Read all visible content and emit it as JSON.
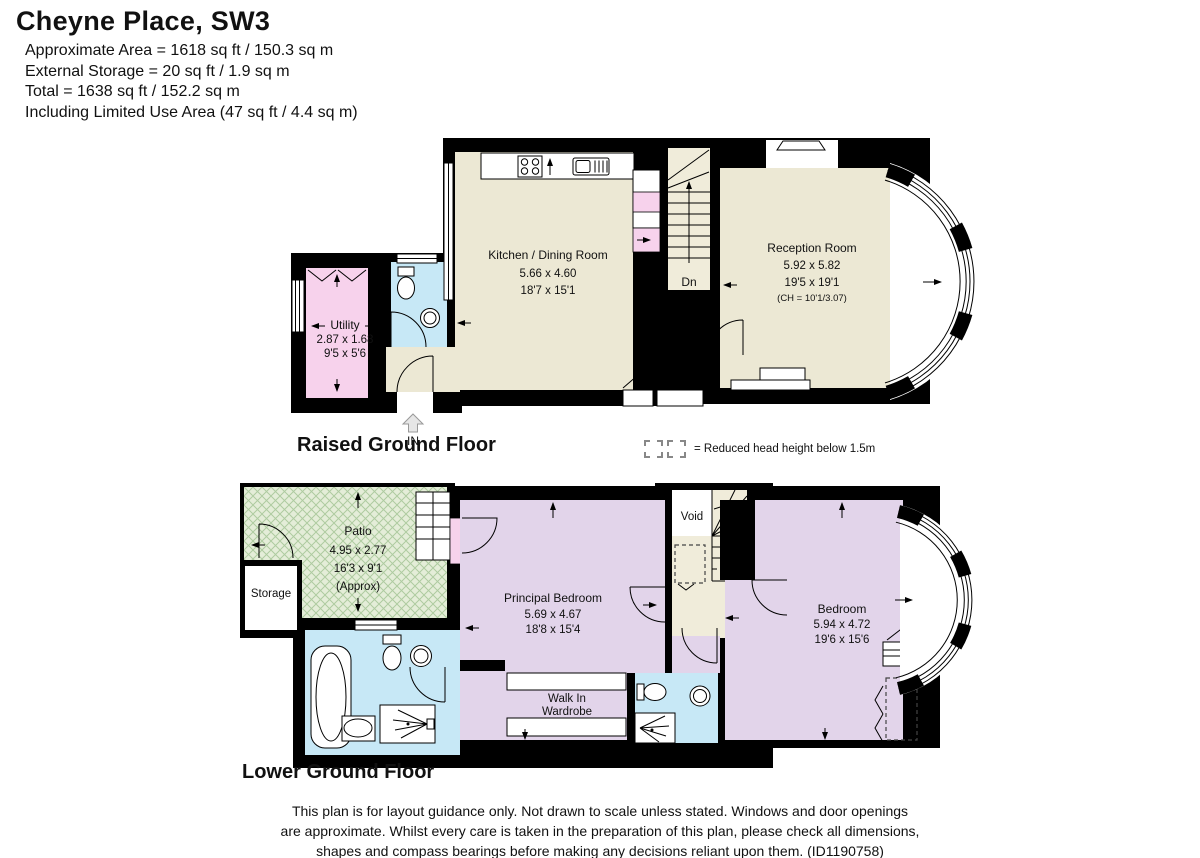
{
  "header": {
    "title": "Cheyne Place, SW3",
    "lines": [
      "Approximate Area = 1618 sq ft / 150.3 sq m",
      "External Storage = 20 sq ft / 1.9 sq m",
      "Total = 1638 sq ft / 152.2 sq m",
      "Including Limited Use Area (47 sq ft / 4.4 sq m)"
    ]
  },
  "floors": {
    "raised_ground": {
      "label": "Raised Ground Floor",
      "stairs_label": "Dn",
      "entrance_label": "IN",
      "rooms": {
        "utility": {
          "name": "Utility",
          "metric": "2.87 x 1.68",
          "imperial": "9'5 x 5'6"
        },
        "kitchen": {
          "name": "Kitchen / Dining Room",
          "metric": "5.66 x 4.60",
          "imperial": "18'7 x 15'1"
        },
        "reception": {
          "name": "Reception Room",
          "metric": "5.92 x 5.82",
          "imperial": "19'5 x 19'1",
          "ceiling": "(CH = 10'1/3.07)"
        }
      }
    },
    "lower_ground": {
      "label": "Lower Ground Floor",
      "stairs_label": "Up",
      "rooms": {
        "patio": {
          "name": "Patio",
          "metric": "4.95 x 2.77",
          "imperial": "16'3 x 9'1",
          "approx": "(Approx)"
        },
        "storage": {
          "name": "Storage"
        },
        "void": {
          "name": "Void"
        },
        "principal_bedroom": {
          "name": "Principal Bedroom",
          "metric": "5.69 x 4.67",
          "imperial": "18'8 x 15'4"
        },
        "walk_in_wardrobe": {
          "line1": "Walk In",
          "line2": "Wardrobe"
        },
        "bedroom": {
          "name": "Bedroom",
          "metric": "5.94 x 4.72",
          "imperial": "19'6 x 15'6"
        }
      }
    }
  },
  "legend": {
    "text": "= Reduced head height below 1.5m"
  },
  "footer": {
    "lines": [
      "This plan is for layout guidance only. Not drawn to scale unless stated. Windows and door openings",
      "are approximate. Whilst every care is taken in the preparation of this plan, please check all dimensions,",
      "shapes and compass bearings before making any decisions reliant upon them. (ID1190758)"
    ]
  },
  "colors": {
    "wall": "#000000",
    "room_beige": "#ECE8D4",
    "bedroom_lavender": "#E2D4EA",
    "bathroom_blue": "#C7E8F6",
    "utility_pink": "#F7D2EC",
    "patio_green": "#E4EDD8"
  }
}
